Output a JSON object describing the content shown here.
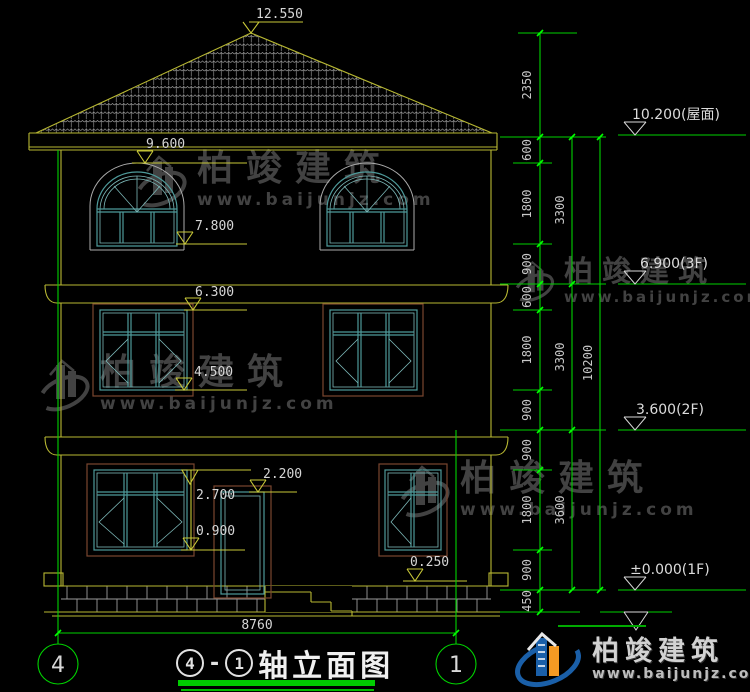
{
  "drawing": {
    "facade_markers": {
      "ridge": "12.550",
      "window3_head": "9.600",
      "window3_sill": "7.800",
      "window2_head": "6.300",
      "window2_sill": "4.500",
      "window1_head": "2.700",
      "door_head": "2.200",
      "window1_sill": "0.900",
      "porch": "0.250"
    },
    "level_markers": {
      "roof": "10.200(屋面)",
      "f3": "6.900(3F)",
      "f2": "3.600(2F)",
      "f1": "±0.000(1F)"
    },
    "chain_a": [
      "2350",
      "600",
      "1800",
      "900",
      "600",
      "1800",
      "900",
      "900",
      "1800",
      "900",
      "450"
    ],
    "chain_b": [
      "3300",
      "3300",
      "3600"
    ],
    "total_height": "10200",
    "overall_width": "8760",
    "axis_left": "4",
    "axis_right": "1"
  },
  "title": {
    "separator": "-",
    "text": "轴立面图"
  },
  "watermark": {
    "name": "柏竣建筑",
    "url": "www.baijunjz.com"
  },
  "brand": {
    "name": "柏竣建筑",
    "url": "www.baijunjz.com"
  }
}
